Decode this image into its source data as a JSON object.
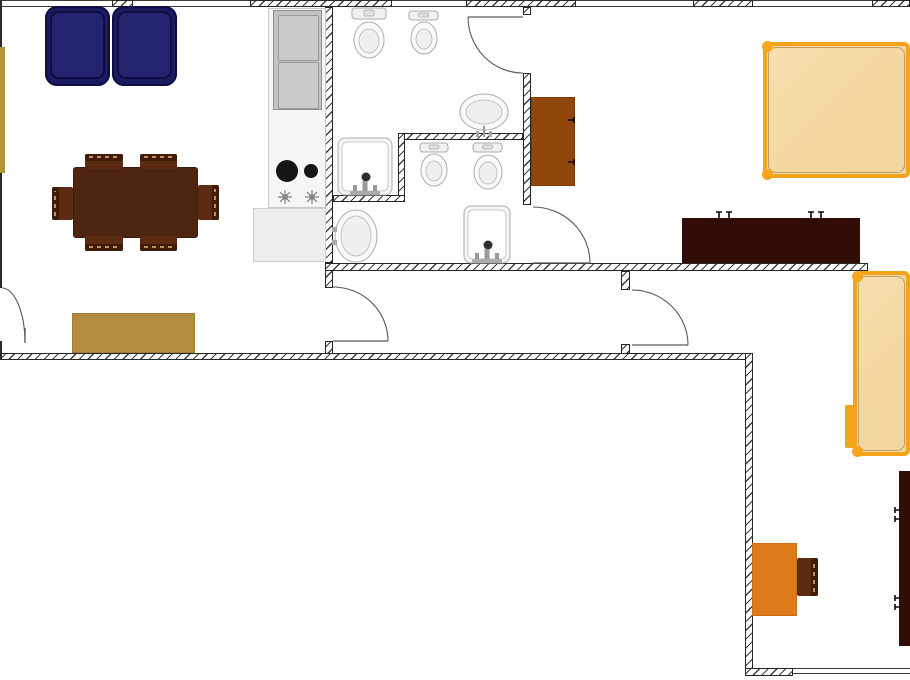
{
  "meta": {
    "description": "apartment floor plan, top-down view, no visible text",
    "canvas": {
      "w": 910,
      "h": 680
    }
  },
  "palette": {
    "wall_hatch": "#3b3b3b",
    "wall_border": "#262626",
    "window_line": "#3c3c3c",
    "door_stroke": "#5a5a5a",
    "sofa_navy": "#1b1b60",
    "sofa_cushion": "#23236e",
    "sofa_edge": "#0e0e44",
    "table_wood": "#4e2510",
    "chair_wood": "#5c2b12",
    "chair_back": "#3f1c08",
    "stitch_tan": "#c09060",
    "gold": "#b28c3f",
    "counter": "#f6f6f6",
    "counter_low": "#ededed",
    "fridge_gray": "#c2c2c2",
    "burner_black": "#151515",
    "fixture_stroke": "#acacac",
    "fixture_fill": "#fafafa",
    "fixture_inner": "#efefef",
    "cabinet_brown": "#90470c",
    "bed_fill": "#f3d7a0",
    "bed_frame": "#f2a41d",
    "bed_post": "#f6a51c",
    "bed_inner_line": "#c7a063",
    "dresser_dark": "#300d05",
    "handle_dark": "#140602",
    "desk_orange": "#dc7a1c",
    "faucet_gray": "#9a9a9a"
  },
  "plan": {
    "walls": [
      {
        "name": "wall-top-pier-1",
        "x": 112,
        "y": 0,
        "w": 21,
        "h": 7
      },
      {
        "name": "wall-top-2",
        "x": 250,
        "y": 0,
        "w": 142,
        "h": 7
      },
      {
        "name": "wall-top-3",
        "x": 466,
        "y": 0,
        "w": 110,
        "h": 7
      },
      {
        "name": "wall-top-4",
        "x": 693,
        "y": 0,
        "w": 60,
        "h": 7
      },
      {
        "name": "wall-top-5",
        "x": 872,
        "y": 0,
        "w": 38,
        "h": 7
      },
      {
        "name": "wall-kitchen-bath",
        "x": 325,
        "y": 7,
        "w": 8,
        "h": 256
      },
      {
        "name": "wall-hall1-left-upper",
        "x": 325,
        "y": 263,
        "w": 8,
        "h": 25
      },
      {
        "name": "wall-hall1-left-lower",
        "x": 325,
        "y": 341,
        "w": 8,
        "h": 14
      },
      {
        "name": "wall-bath-bedroom-top",
        "x": 523,
        "y": 7,
        "w": 8,
        "h": 8
      },
      {
        "name": "wall-bath-bedroom-mid",
        "x": 523,
        "y": 73,
        "w": 8,
        "h": 132
      },
      {
        "name": "wall-bath-partition-h1",
        "x": 398,
        "y": 133,
        "w": 125,
        "h": 7
      },
      {
        "name": "wall-bath-partition-v",
        "x": 398,
        "y": 133,
        "w": 7,
        "h": 69
      },
      {
        "name": "wall-bath-partition-h2",
        "x": 333,
        "y": 195,
        "w": 72,
        "h": 7
      },
      {
        "name": "wall-main-horizontal",
        "x": 325,
        "y": 263,
        "w": 543,
        "h": 8
      },
      {
        "name": "wall-hall2-left-upper",
        "x": 621,
        "y": 271,
        "w": 9,
        "h": 19
      },
      {
        "name": "wall-hall2-left-lower",
        "x": 621,
        "y": 344,
        "w": 9,
        "h": 11
      },
      {
        "name": "wall-bottom-left",
        "x": 0,
        "y": 353,
        "w": 753,
        "h": 7
      },
      {
        "name": "wall-room2-left",
        "x": 745,
        "y": 353,
        "w": 8,
        "h": 322
      },
      {
        "name": "wall-bottom-right-pier",
        "x": 745,
        "y": 668,
        "w": 48,
        "h": 8
      }
    ],
    "windows": [
      {
        "name": "window-top-1",
        "x": 0,
        "y": 0,
        "w": 112,
        "h": 7
      },
      {
        "name": "window-top-2",
        "x": 133,
        "y": 0,
        "w": 117,
        "h": 7
      },
      {
        "name": "window-top-3",
        "x": 392,
        "y": 0,
        "w": 74,
        "h": 7
      },
      {
        "name": "window-top-4",
        "x": 576,
        "y": 0,
        "w": 117,
        "h": 7
      },
      {
        "name": "window-top-5",
        "x": 753,
        "y": 0,
        "w": 119,
        "h": 7
      },
      {
        "name": "window-bottom-right",
        "x": 793,
        "y": 668,
        "w": 117,
        "h": 6
      }
    ],
    "lines": [
      {
        "name": "wall-left-edge-upper",
        "x": 0,
        "y": 0,
        "w": 2,
        "h": 288,
        "c": "#2a2a2a"
      },
      {
        "name": "wall-left-edge-lower",
        "x": 0,
        "y": 341,
        "w": 2,
        "h": 19,
        "c": "#2a2a2a"
      },
      {
        "name": "counter-divider",
        "x": 269,
        "y": 154,
        "w": 56,
        "h": 1,
        "c": "#dcdcdc"
      }
    ],
    "doors": [
      {
        "name": "door-bathroom-1",
        "arc": "M 468 17 A 55 56 0 0 0 523 73",
        "leaf": "M 523 17 L 468 17"
      },
      {
        "name": "door-bathroom-2",
        "arc": "M 533 207 A 57 56 0 0 1 590 263",
        "leaf": "M 533 263 L 590 263"
      },
      {
        "name": "door-hall-1",
        "arc": "M 333 287 A 55 54 0 0 1 388 341",
        "leaf": "M 333 341 L 388 341"
      },
      {
        "name": "door-hall-2",
        "arc": "M 632 290 A 56 55 0 0 1 688 345",
        "leaf": "M 632 345 L 688 345"
      },
      {
        "name": "door-living-left",
        "arc": "M 2 288 A 23 55 0 0 1 25 343",
        "leaf": "M 25 328 L 25 343"
      }
    ],
    "furniture": [
      {
        "name": "sideboard-gold",
        "type": "rect",
        "x": 0,
        "y": 47,
        "w": 5,
        "h": 126,
        "fill": "#b3913d"
      },
      {
        "name": "rug-gold",
        "type": "rect",
        "x": 72,
        "y": 313,
        "w": 123,
        "h": 40,
        "fill": "#b28c3f",
        "border": "#a07f35"
      },
      {
        "name": "sofa-navy",
        "type": "sofa",
        "x": 45,
        "y": 6,
        "w": 132,
        "h": 80,
        "fill": "#1b1b60",
        "cushion": "#23236e",
        "edge": "#0e0e44"
      },
      {
        "name": "dining-table",
        "type": "rect",
        "x": 73,
        "y": 167,
        "w": 125,
        "h": 71,
        "fill": "#4e2510",
        "border": "#3c1c0a",
        "radius": 3
      },
      {
        "name": "dining-chair-top-1",
        "type": "chair",
        "x": 85,
        "y": 154,
        "w": 38,
        "h": 15,
        "back": "top"
      },
      {
        "name": "dining-chair-top-2",
        "type": "chair",
        "x": 140,
        "y": 154,
        "w": 37,
        "h": 15,
        "back": "top"
      },
      {
        "name": "dining-chair-bottom-1",
        "type": "chair",
        "x": 85,
        "y": 236,
        "w": 38,
        "h": 15,
        "back": "bottom"
      },
      {
        "name": "dining-chair-bottom-2",
        "type": "chair",
        "x": 140,
        "y": 236,
        "w": 37,
        "h": 15,
        "back": "bottom"
      },
      {
        "name": "dining-chair-left",
        "type": "chair",
        "x": 52,
        "y": 187,
        "w": 21,
        "h": 33,
        "back": "left"
      },
      {
        "name": "dining-chair-right",
        "type": "chair",
        "x": 198,
        "y": 185,
        "w": 21,
        "h": 35,
        "back": "right"
      },
      {
        "name": "kitchen-counter",
        "type": "rect",
        "x": 268,
        "y": 8,
        "w": 58,
        "h": 200,
        "fill": "#f6f6f6",
        "border": "#c8c8c8"
      },
      {
        "name": "kitchen-counter-lower",
        "type": "rect",
        "x": 253,
        "y": 208,
        "w": 73,
        "h": 54,
        "fill": "#ededed",
        "border": "#cfcfcf"
      },
      {
        "name": "fridge",
        "type": "fridge",
        "x": 273,
        "y": 10,
        "w": 49,
        "h": 100,
        "fill": "#c2c2c2",
        "panel": "#cbcbcb"
      },
      {
        "name": "cabinet-bedroom-1",
        "type": "rect",
        "x": 531,
        "y": 97,
        "w": 44,
        "h": 89,
        "fill": "#90470c",
        "border": "#7c3c08"
      },
      {
        "name": "bed-1",
        "type": "bed",
        "x": 763,
        "y": 42,
        "w": 147,
        "h": 136,
        "dots": [
          [
            767,
            46
          ],
          [
            767,
            174
          ]
        ]
      },
      {
        "name": "dresser-bedroom-1",
        "type": "rect",
        "x": 682,
        "y": 218,
        "w": 178,
        "h": 45,
        "fill": "#300d05"
      },
      {
        "name": "bed-2",
        "type": "bed",
        "x": 853,
        "y": 271,
        "w": 57,
        "h": 185,
        "dots": [
          [
            857,
            276
          ],
          [
            857,
            451
          ]
        ],
        "tab": {
          "x": 845,
          "y": 405,
          "w": 9,
          "h": 43
        }
      },
      {
        "name": "desk-orange",
        "type": "rect",
        "x": 752,
        "y": 543,
        "w": 45,
        "h": 73,
        "fill": "#dc7a1c",
        "border": "#c96f15"
      },
      {
        "name": "desk-chair",
        "type": "chair",
        "x": 797,
        "y": 558,
        "w": 21,
        "h": 38,
        "back": "right"
      },
      {
        "name": "dresser-room-2",
        "type": "rect",
        "x": 899,
        "y": 471,
        "w": 11,
        "h": 175,
        "fill": "#300d05"
      }
    ],
    "fixtures": [
      {
        "name": "toilet-1",
        "type": "toilet",
        "tank": [
          352,
          8,
          34,
          11
        ],
        "bowl": [
          369,
          40,
          15,
          18
        ]
      },
      {
        "name": "toilet-2",
        "type": "toilet",
        "tank": [
          409,
          11,
          29,
          9
        ],
        "bowl": [
          424,
          38,
          13,
          16
        ]
      },
      {
        "name": "sink-pedestal-1",
        "type": "sink_oval",
        "cx": 484,
        "cy": 112,
        "rx": 24,
        "ry": 18,
        "faucet": "bottom"
      },
      {
        "name": "sink-basin-1",
        "type": "sink_square",
        "x": 338,
        "y": 138,
        "w": 54,
        "h": 57
      },
      {
        "name": "toilet-3",
        "type": "toilet",
        "tank": [
          420,
          143,
          28,
          9
        ],
        "bowl": [
          434,
          170,
          13,
          16
        ]
      },
      {
        "name": "toilet-4",
        "type": "toilet",
        "tank": [
          473,
          143,
          29,
          9
        ],
        "bowl": [
          488,
          172,
          14,
          17
        ]
      },
      {
        "name": "sink-pedestal-2",
        "type": "sink_oval",
        "cx": 356,
        "cy": 236,
        "rx": 21,
        "ry": 26,
        "faucet": "left"
      },
      {
        "name": "sink-basin-2",
        "type": "sink_square",
        "x": 464,
        "y": 206,
        "w": 46,
        "h": 57
      },
      {
        "name": "stove-burner-large",
        "type": "burner",
        "cx": 287,
        "cy": 171,
        "r": 11
      },
      {
        "name": "stove-burner-small",
        "type": "burner",
        "cx": 311,
        "cy": 171,
        "r": 7
      },
      {
        "name": "stove-spark-1",
        "type": "spark",
        "cx": 285,
        "cy": 197
      },
      {
        "name": "stove-spark-2",
        "type": "spark",
        "cx": 312,
        "cy": 197
      },
      {
        "name": "dresser-1-handles",
        "type": "handles",
        "dir": "down",
        "glyphs": [
          [
            719,
            212
          ],
          [
            729,
            212
          ],
          [
            811,
            212
          ],
          [
            821,
            212
          ]
        ]
      },
      {
        "name": "dresser-2-handles",
        "type": "handles",
        "dir": "right",
        "glyphs": [
          [
            895,
            510
          ],
          [
            895,
            519
          ],
          [
            895,
            598
          ],
          [
            895,
            607
          ]
        ]
      },
      {
        "name": "cabinet-handles",
        "type": "handles",
        "dir": "left",
        "glyphs": [
          [
            574,
            120
          ],
          [
            574,
            162
          ]
        ]
      }
    ]
  }
}
